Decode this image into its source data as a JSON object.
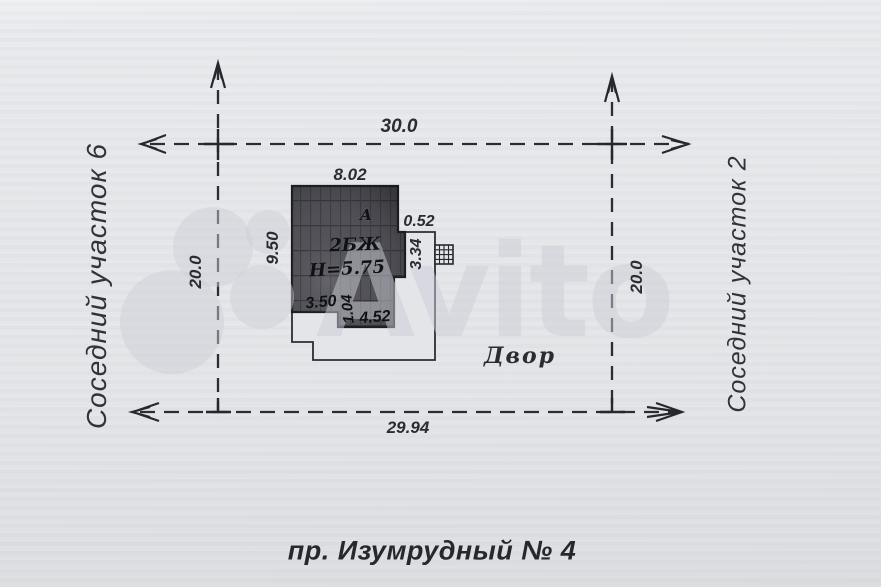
{
  "watermark": {
    "brand": "Avito"
  },
  "labels": {
    "neighbor_left": "Соседний участок 6",
    "neighbor_right": "Соседний участок 2",
    "street": "пр. Изумрудный  № 4",
    "yard": "Двор"
  },
  "boundary_dims": {
    "top": "30.0",
    "bottom": "29.94",
    "left": "20.0",
    "right": "20.0"
  },
  "building": {
    "corner_letter": "А",
    "type_label": "2БЖ",
    "height_label": "Н=5.75",
    "dim_top": "8.02",
    "dim_left": "9.50",
    "dim_step_right": "0.52",
    "dim_annex_right": "3.34",
    "dim_bottom_left": "3.50",
    "dim_bottom_step": "1.04",
    "dim_bottom_right": "4.52"
  },
  "colors": {
    "ink": "#2b2d33",
    "paper": "#e5e6e9",
    "building_fill": "#4a4b51",
    "watermark": "#ccd0d9"
  }
}
